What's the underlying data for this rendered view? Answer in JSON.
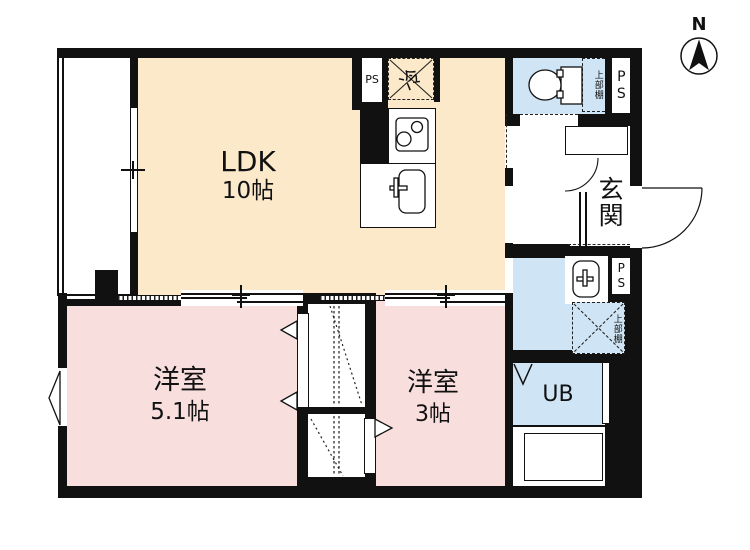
{
  "compass": {
    "label": "N"
  },
  "rooms": {
    "ldk": {
      "name": "LDK",
      "area": "10帖"
    },
    "bedroom_main": {
      "name": "洋室",
      "area": "5.1帖"
    },
    "bedroom_small": {
      "name": "洋室",
      "area": "3帖"
    },
    "entrance": {
      "name": "玄関"
    },
    "unit_bath": {
      "name": "UB"
    }
  },
  "fixtures": {
    "refrigerator": "冷",
    "pipe_space": "PS",
    "upper_shelf": "上部棚"
  },
  "colors": {
    "ldk_fill": "#fbe9ca",
    "bedroom_fill": "#f8dedd",
    "wet_area_fill": "#cfe4f4",
    "wall": "#111111"
  }
}
